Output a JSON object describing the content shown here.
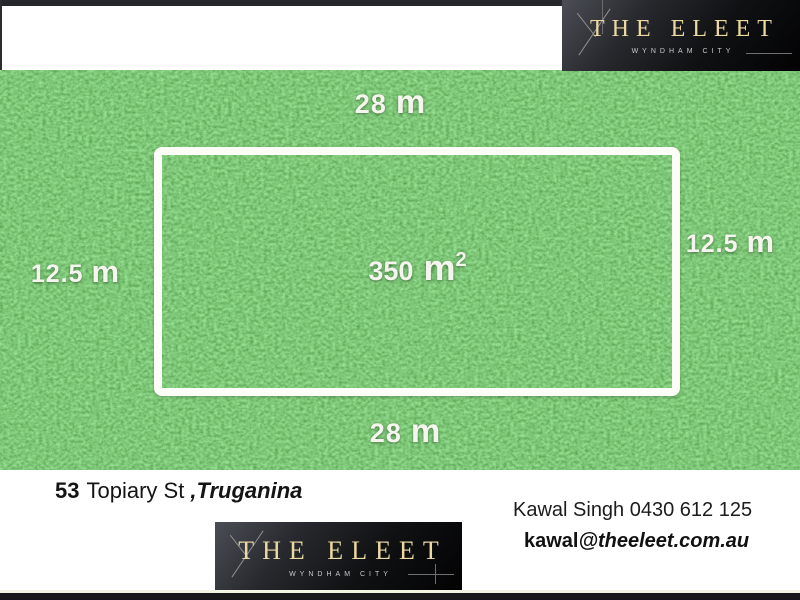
{
  "brand": {
    "name": "THE ELEET",
    "tagline": "WYNDHAM CITY"
  },
  "plot": {
    "top": {
      "value": "28",
      "unit": "m"
    },
    "bottom": {
      "value": "28",
      "unit": "m"
    },
    "left": {
      "value": "12.5",
      "unit": "m"
    },
    "right": {
      "value": "12.5",
      "unit": "m"
    },
    "area": {
      "value": "350",
      "unit": "m",
      "power": "2"
    }
  },
  "address": {
    "number": "53",
    "street": "Topiary St",
    "comma": ",",
    "suburb": "Truganina"
  },
  "contact": {
    "agent": "Kawal Singh 0430 612 125",
    "email_user": "kawal",
    "email_domain": "@theeleet.com.au"
  },
  "colors": {
    "grass": "#3f9437",
    "frame": "#ffffff",
    "logo_gold": "#ecd9a0",
    "logo_bg": "#101113",
    "bar_dark": "#25272b"
  }
}
